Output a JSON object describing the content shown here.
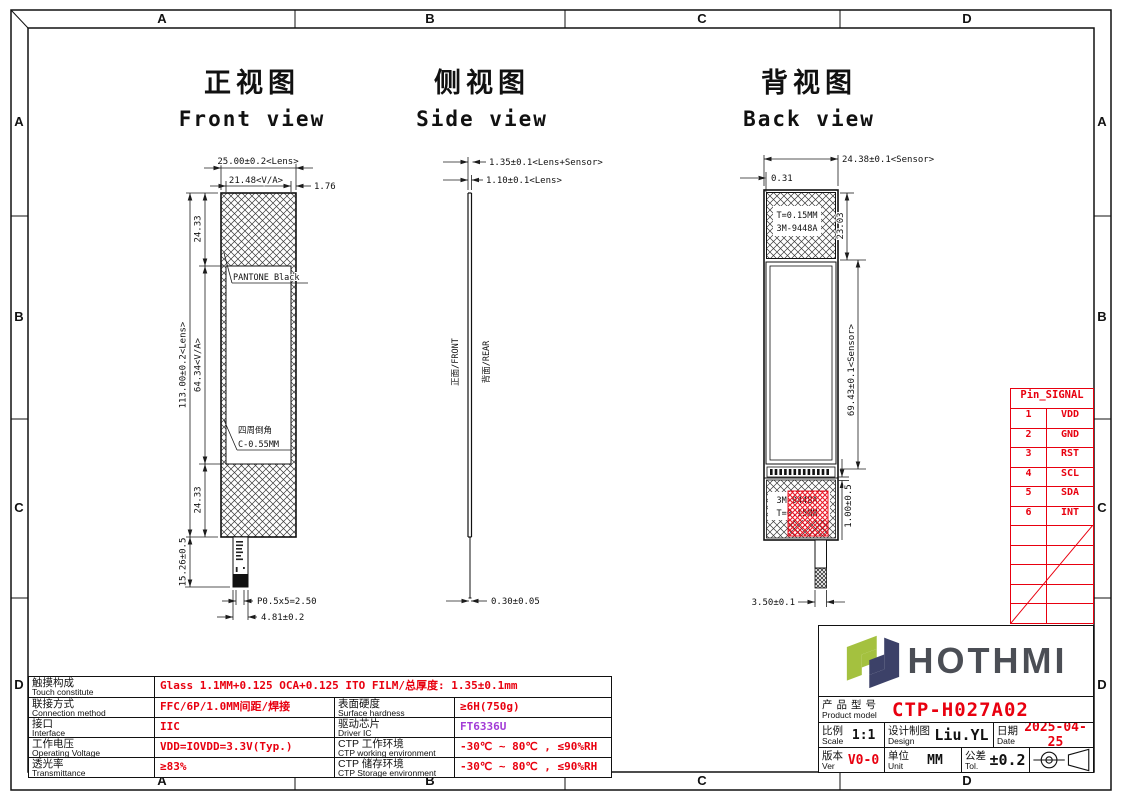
{
  "colors": {
    "red": "#e8000f",
    "purple": "#a23bd6",
    "line": "#111111",
    "logo_green": "#a4c13f",
    "logo_navy": "#3c4168",
    "logo_text": "#4b4e55"
  },
  "frame": {
    "cols": [
      "A",
      "B",
      "C",
      "D"
    ],
    "rows": [
      "A",
      "B",
      "C",
      "D"
    ]
  },
  "views": {
    "front": {
      "title_zh": "正视图",
      "title_en": "Front view",
      "dim_lens_w": "25.00±0.2<Lens>",
      "dim_va_w": "21.48<V/A>",
      "dim_border_w": "1.76",
      "dim_lens_h": "113.00±0.2<Lens>",
      "dim_va_h": "64.34<V/A>",
      "dim_top_band": "24.33",
      "dim_bottom_band": "24.33",
      "dim_tail_h": "15.26±0.5",
      "dim_pins": "P0.5x5=2.50",
      "dim_tail_w": "4.81±0.2",
      "label_pantone": "PANTONE Black",
      "label_chamfer_zh": "四周倒角",
      "label_chamfer_val": "C-0.55MM"
    },
    "side": {
      "title_zh": "侧视图",
      "title_en": "Side view",
      "dim_total_t": "1.35±0.1<Lens+Sensor>",
      "dim_lens_t": "1.10±0.1<Lens>",
      "dim_ffc_t": "0.30±0.05",
      "label_front": "正面/FRONT",
      "label_rear": "背面/REAR"
    },
    "back": {
      "title_zh": "背视图",
      "title_en": "Back view",
      "dim_sensor_w": "24.38±0.1<Sensor>",
      "dim_edge": "0.31",
      "dim_tape_h": "23.03",
      "dim_sensor_h": "69.43±0.1<Sensor>",
      "dim_gap": "1.00±0.5",
      "dim_tail_w": "3.50±0.1",
      "tape_line1": "T=0.15MM",
      "tape_line2": "3M-9448A",
      "bottom_line1": "3M-9448A",
      "bottom_line2": "T=0.15MM"
    }
  },
  "pin_table": {
    "header": "Pin_SIGNAL",
    "rows": [
      {
        "pin": "1",
        "signal": "VDD"
      },
      {
        "pin": "2",
        "signal": "GND"
      },
      {
        "pin": "3",
        "signal": "RST"
      },
      {
        "pin": "4",
        "signal": "SCL"
      },
      {
        "pin": "5",
        "signal": "SDA"
      },
      {
        "pin": "6",
        "signal": "INT"
      }
    ]
  },
  "spec_table": {
    "row1": {
      "zh": "触摸构成",
      "en": "Touch constitute",
      "value": "Glass 1.1MM+0.125 OCA+0.125 ITO FILM/总厚度: 1.35±0.1mm"
    },
    "row2": {
      "zh": "联接方式",
      "en": "Connection method",
      "value": "FFC/6P/1.0MM间距/焊接",
      "zh2": "表面硬度",
      "en2": "Surface hardness",
      "value2": "≥6H(750g)"
    },
    "row3": {
      "zh": "接口",
      "en": "Interface",
      "value": "IIC",
      "zh2": "驱动芯片",
      "en2": "Driver IC",
      "value2": "FT6336U"
    },
    "row4": {
      "zh": "工作电压",
      "en": "Operating Voltage",
      "value": "VDD=IOVDD=3.3V(Typ.)",
      "zh2": "CTP 工作环境",
      "en2": "CTP working environment",
      "value2": "-30℃ ~ 80℃ , ≤90%RH"
    },
    "row5": {
      "zh": "透光率",
      "en": "Transmittance",
      "value": "≥83%",
      "zh2": "CTP 储存环境",
      "en2": "CTP Storage environment",
      "value2": "-30℃ ~ 80℃ , ≤90%RH"
    }
  },
  "title_block": {
    "brand": "HOTHMI",
    "model_label_zh": "产品型号",
    "model_label_en": "Product model",
    "model_value": "CTP-H027A02",
    "scale_zh": "比例",
    "scale_en": "Scale",
    "scale_value": "1:1",
    "design_zh": "设计制图",
    "design_en": "Design",
    "design_value": "Liu.YL",
    "date_zh": "日期",
    "date_en": "Date",
    "date_value": "2025-04-25",
    "ver_zh": "版本",
    "ver_en": "Ver",
    "ver_value": "V0-0",
    "unit_zh": "单位",
    "unit_en": "Unit",
    "unit_value": "MM",
    "tol_zh": "公差",
    "tol_en": "Tol.",
    "tol_value": "±0.2"
  }
}
